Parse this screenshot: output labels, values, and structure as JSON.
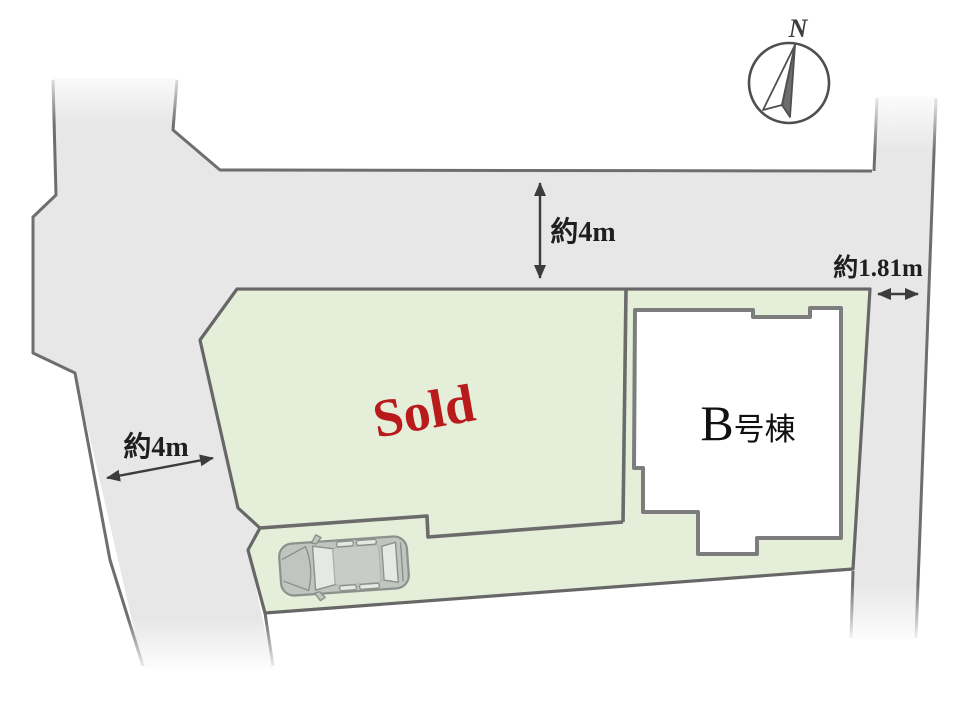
{
  "plan": {
    "compass": "N",
    "sold_label": "Sold",
    "building_label": "B",
    "building_label_suffix": "号棟",
    "dim_top_road": "約4m",
    "dim_left_road": "約4m",
    "dim_right_side": "約1.81m"
  },
  "colors": {
    "road_fill": "#e7e7e7",
    "road_border": "#6e6e6e",
    "plot_fill": "#e4eed9",
    "plot_border": "#676767",
    "building_fill": "#ffffff",
    "building_border": "#7d7d7d",
    "divider": "#6b6b6b",
    "sold_text": "#b91a1c",
    "dim_text": "#1f1f1f",
    "arrow": "#3c3c3c",
    "compass_stroke": "#4f4f4f",
    "car_body": "#c0c5c0",
    "car_outline": "#8b918b",
    "car_glass": "#e5e8e3",
    "car_roof": "#c8ccc7"
  }
}
